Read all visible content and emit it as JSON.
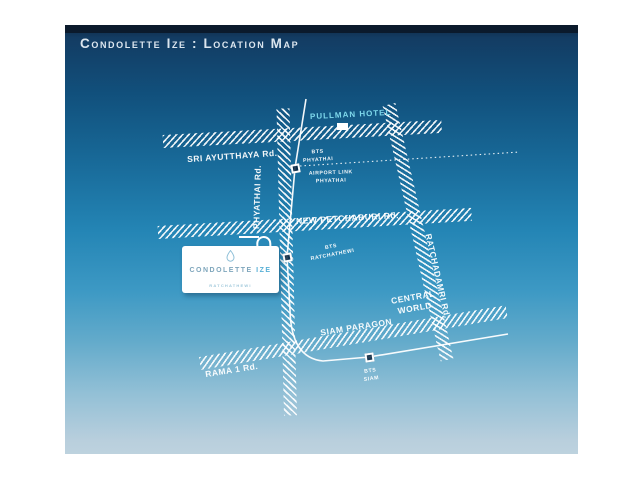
{
  "header": {
    "title": "Condolette Ize : Location Map"
  },
  "map": {
    "landmarks": {
      "pullman_hotel": "PULLMAN HOTEL",
      "central_world": [
        "CENTRAL",
        "WORLD"
      ],
      "siam_paragon": "SIAM PARAGON"
    },
    "roads": {
      "sri_ayutthaya": "SRI AYUTTHAYA Rd.",
      "phyathai": "PHYATHAI Rd.",
      "new_petchaburi": "NEW PETCHABURI Rd.",
      "rama1": "RAMA 1 Rd.",
      "ratchadamri": "RATCHADAMRI Rd."
    },
    "stations": {
      "bts_phyathai": [
        "BTS",
        "PHYATHAI"
      ],
      "airport_link_phyathai": [
        "AIRPORT LINK",
        "PHYATHAI"
      ],
      "bts_ratchathewi": [
        "BTS",
        "RATCHATHEWI"
      ],
      "bts_siam": [
        "BTS",
        "SIAM"
      ]
    },
    "project_card": {
      "name_primary": "CONDOLETTE",
      "name_accent": "IZE",
      "subtitle": "RATCHATHEWI"
    }
  },
  "colors": {
    "background_top": "#0e2844",
    "background_mid": "#2485b5",
    "background_bottom": "#bdd2de",
    "top_bar": "#0b1a2c",
    "title_text": "#dce6ef",
    "landmark_accent": "#7fd9ec",
    "road_hatch": "#ffffff",
    "card_name": "#7fa6bc",
    "card_name_accent": "#58b0d6"
  }
}
